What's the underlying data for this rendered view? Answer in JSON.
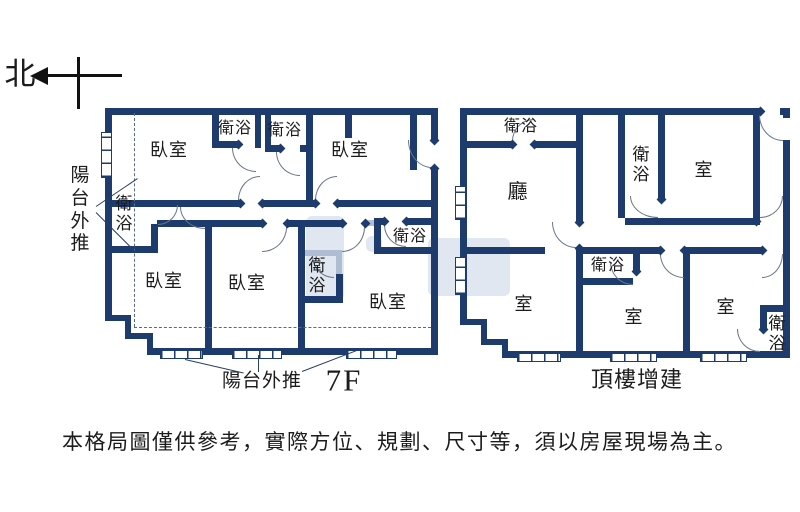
{
  "compass": {
    "north": "北"
  },
  "plan_left": {
    "floor_label": "7F",
    "balcony_side_label": "陽台外推",
    "balcony_bottom_label": "陽台外推",
    "rooms": {
      "bedroom_top_left": "臥室",
      "bath_top_1": "衛浴",
      "bath_top_2": "衛浴",
      "bedroom_top_right": "臥室",
      "bath_left": "衛浴",
      "bedroom_bottom_left": "臥室",
      "bedroom_bottom_mid": "臥室",
      "bath_center": "衛浴",
      "bath_right": "衛浴",
      "bedroom_bottom_right": "臥室"
    }
  },
  "plan_right": {
    "floor_label": "頂樓增建",
    "rooms": {
      "bath_top_left": "衛浴",
      "living": "廳",
      "bath_top_mid": "衛浴",
      "room_top_right": "室",
      "room_bottom_left": "室",
      "bath_mid": "衛浴",
      "room_bottom_mid": "室",
      "room_bottom_right": "室",
      "bath_bottom_right": "衛浴"
    }
  },
  "disclaimer": {
    "text": "本格局圖僅供參考，實際方位、規劃、尺寸等，須以房屋現場為主。"
  },
  "colors": {
    "wall": "#1d3b6d",
    "wall_light": "#aebdd3",
    "dashed": "#55688f"
  }
}
